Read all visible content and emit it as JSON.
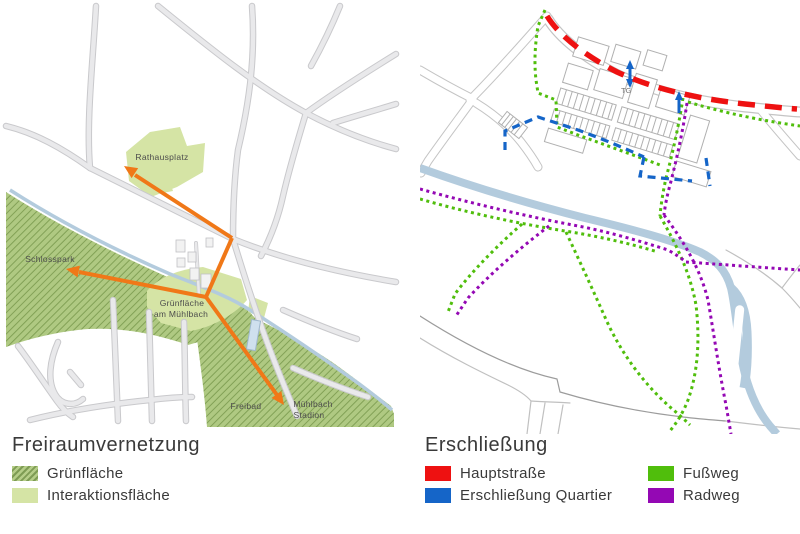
{
  "colors": {
    "hauptstrasse_red": "#ee1111",
    "erschliessung_quartier_blue": "#1565c8",
    "fussweg_green": "#50be0c",
    "radweg_purple": "#9408b4",
    "gruenflaeche_base_green": "#afc982",
    "gruenflaeche_hatch_green": "#82a156",
    "interaktionsflaeche_green": "#d5e4a5",
    "connection_arrow_orange": "#f07818",
    "water_blue": "#b3cbdd",
    "road_gray": "#c9c9cc"
  },
  "left_panel": {
    "legend_title": "Freiraumvernetzung",
    "legend_items": [
      {
        "label": "Grünfläche",
        "swatch": "hatched-green"
      },
      {
        "label": "Interaktionsfläche",
        "swatch": "light-green"
      }
    ],
    "map_labels": {
      "rathausplatz": "Rathausplatz",
      "schlosspark": "Schlosspark",
      "gruenflaeche_line1": "Grünfläche",
      "gruenflaeche_line2": "am Mühlbach",
      "freibad": "Freibad",
      "stadion_line1": "Mühlbach",
      "stadion_line2": "Stadion"
    }
  },
  "right_panel": {
    "legend_title": "Erschließung",
    "legend_items": [
      {
        "label": "Hauptstraße",
        "color": "#ee1111"
      },
      {
        "label": "Erschließung Quartier",
        "color": "#1565c8"
      },
      {
        "label": "Fußweg",
        "color": "#50be0c"
      },
      {
        "label": "Radweg",
        "color": "#9408b4"
      }
    ],
    "map_labels": {
      "tiefgarage": "TG"
    }
  }
}
